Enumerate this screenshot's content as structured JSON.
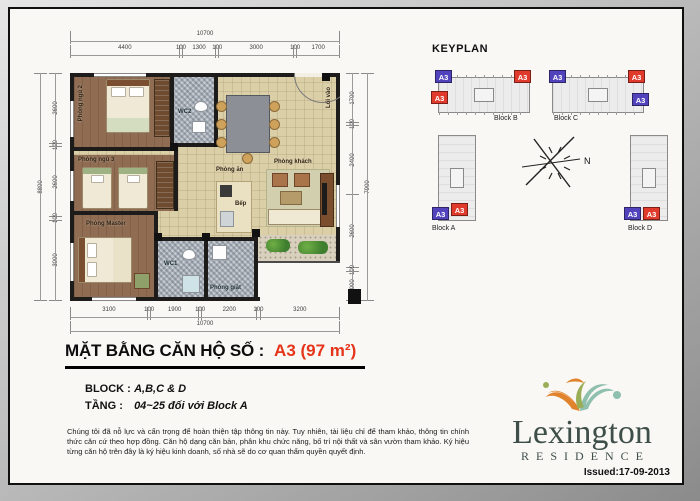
{
  "colors": {
    "accent_red": "#e5341a",
    "badge_red": "#df3a2b",
    "badge_blue": "#5143bb"
  },
  "plan": {
    "rooms": {
      "bedroom2": "Phòng ngủ 2",
      "bedroom3": "Phòng ngủ 3",
      "master": "Phòng Master",
      "dining": "Phòng ăn",
      "living": "Phòng khách",
      "kitchen": "Bếp",
      "wc1": "WC1",
      "wc2": "WC2",
      "laundry": "Phòng giặt",
      "entry": "Lối vào"
    },
    "dims": {
      "top_total": "10700",
      "top": [
        "4400",
        "100",
        "1300",
        "100",
        "3000",
        "100",
        "1700"
      ],
      "bottom": [
        "3100",
        "100",
        "1900",
        "100",
        "2200",
        "100",
        "3200"
      ],
      "bottom_total": "10700",
      "left_total": "8800",
      "left": [
        "2600",
        "100",
        "2600",
        "100",
        "3000"
      ],
      "right": [
        "1700",
        "100",
        "2400",
        "2600",
        "100",
        "1000"
      ],
      "right_total": "7900"
    }
  },
  "keyplan": {
    "title": "KEYPLAN",
    "north_label": "N",
    "unit_label": "A3",
    "blocks": [
      {
        "name": "Block A"
      },
      {
        "name": "Block B"
      },
      {
        "name": "Block C"
      },
      {
        "name": "Block D"
      }
    ]
  },
  "title": {
    "label": "MẶT BẰNG CĂN HỘ SỐ :",
    "value": "A3 (97 m²)"
  },
  "info": {
    "block_label": "BLOCK :",
    "block_value": "A,B,C & D",
    "floor_label": "TẦNG :",
    "floor_value": "04~25 đối với Block A"
  },
  "disclaimer": "Chúng tôi đã nỗ lực và cẩn trọng để hoàn thiện tập thông tin này. Tuy nhiên, tài liệu chỉ để tham khảo, thông tin chính thức căn cứ theo hợp đồng. Căn hộ dạng căn bản, phân khu chức năng, bố trí nội thất và sân vườn tham khảo. Ký hiệu từng căn hộ trên đây là ký hiệu kinh doanh, số nhà sẽ do cơ quan thẩm quyền quyết định.",
  "logo": {
    "name": "Lexington",
    "sub": "RESIDENCE"
  },
  "issued": "Issued:17-09-2013"
}
